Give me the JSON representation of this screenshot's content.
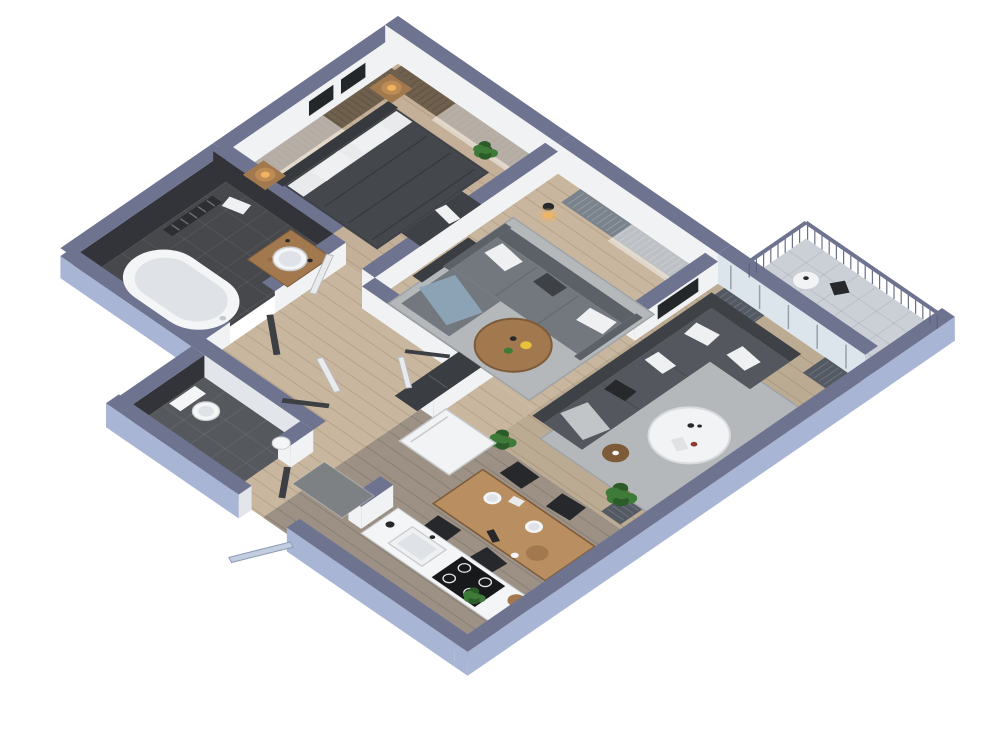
{
  "scene": {
    "title": "3D isometric apartment floor plan render",
    "view": "top-down oblique isometric",
    "background": "#ffffff",
    "wall_height_px": 30
  },
  "rooms": [
    {
      "id": "bedroom",
      "label": "Bedroom",
      "furniture": [
        "double-bed",
        "headboard",
        "pillows",
        "duvet",
        "nightstands",
        "table-lamps",
        "ottoman",
        "wall-art-frames",
        "plant",
        "window-curtains"
      ]
    },
    {
      "id": "living-room",
      "label": "Living room",
      "furniture": [
        "sectional-sofa",
        "chaise",
        "blue-throw",
        "pillows",
        "round-coffee-table",
        "flowers",
        "area-rug",
        "floor-lamp",
        "media-console",
        "window-curtains"
      ]
    },
    {
      "id": "lounge",
      "label": "Lounge",
      "furniture": [
        "corner-sofa",
        "pillows",
        "gray-throw",
        "round-white-table",
        "side-table",
        "area-rug",
        "potted-plants",
        "dark-curtains",
        "wall-art",
        "glass-balcony-doors"
      ]
    },
    {
      "id": "dining-kitchen",
      "label": "Kitchen and dining",
      "furniture": [
        "dining-table",
        "black-chairs",
        "plates",
        "serving-board",
        "tall-cabinet",
        "kitchen-counter",
        "sink",
        "induction-cooktop",
        "cutting-board",
        "floor-decor",
        "potted-plant"
      ]
    },
    {
      "id": "bathroom",
      "label": "Bathroom",
      "furniture": [
        "freestanding-bathtub",
        "wood-vanity",
        "round-basin",
        "towel-radiator",
        "towel"
      ]
    },
    {
      "id": "wc",
      "label": "WC",
      "furniture": [
        "toilet",
        "small-basin"
      ]
    },
    {
      "id": "hallway",
      "label": "Hallway and entry",
      "furniture": [
        "wardrobe",
        "open-doors",
        "doormat",
        "entry-door"
      ]
    },
    {
      "id": "balcony",
      "label": "Balcony",
      "furniture": [
        "railing",
        "bistro-table",
        "chair"
      ]
    }
  ],
  "colors": {
    "background": "#ffffff",
    "wall_top": "#6e7490",
    "wall_outer": "#a9b5d5",
    "wall_outer_shade": "#98a5c7",
    "wall_inner": "#f1f2f4",
    "wall_inner_shade": "#e2e5e9",
    "glass": "#dce4ec",
    "mullion": "#98a1ab",
    "floor_wood": "#c9b69e",
    "floor_wood_bedroom": "#c4b098",
    "floor_wood_lounge": "#bcab93",
    "floor_gray": "#9c9184",
    "plank_line": "rgba(70,50,30,0.14)",
    "bath_floor": "#46484c",
    "bath_wall": "#323439",
    "wc_floor": "#55585d",
    "tile_line": "rgba(255,255,255,0.07)",
    "balcony_floor": "#cbd0d7",
    "balcony_line": "rgba(0,0,0,0.08)",
    "rug": "#b4b8bb",
    "rug_border": "#9fa3a6",
    "sofa_gray": "#73787f",
    "sofa_gray_dark": "#5c6168",
    "sofa_dark": "#54585e",
    "sofa_darker": "#3e4247",
    "bed_duvet": "#44474c",
    "bed_headboard": "#36393d",
    "sheet_white": "#e9eaec",
    "pillow_white": "#eef0f2",
    "blue_throw": "#8ca4b6",
    "gray_throw": "#c2c5c8",
    "wood": "#a2794f",
    "wood_dark": "#7d5b39",
    "wood_light": "#b98e60",
    "table_white": "#f2f3f5",
    "charcoal": "#26282b",
    "curtain_dark": "#545a63",
    "curtain_gray": "#7a828b",
    "curtain_brown": "#6f5f4d",
    "sheer": "#ffffff",
    "plant_green": "#3e7a38",
    "plant_dark": "#2c5c2a",
    "pot_terra": "#9a6a45",
    "pot_dark": "#3a3d41",
    "lamp_glow": "#f5b55f",
    "white_fixture": "#f4f5f6",
    "fixture_shade": "#dfe2e6",
    "steel": "#c6c9cd",
    "doormat": "#7e8184",
    "door_white": "#e9eaec",
    "door_dark": "#3c3f44",
    "door_blue": "#c3cde0",
    "cooktop": "#17191b",
    "deco_red": "#8a3b2e",
    "copper": "#b4764a",
    "yellow": "#e8c23a",
    "art_frame": "#24272a",
    "radiator": "#2c2e31",
    "rail": "#596080"
  }
}
